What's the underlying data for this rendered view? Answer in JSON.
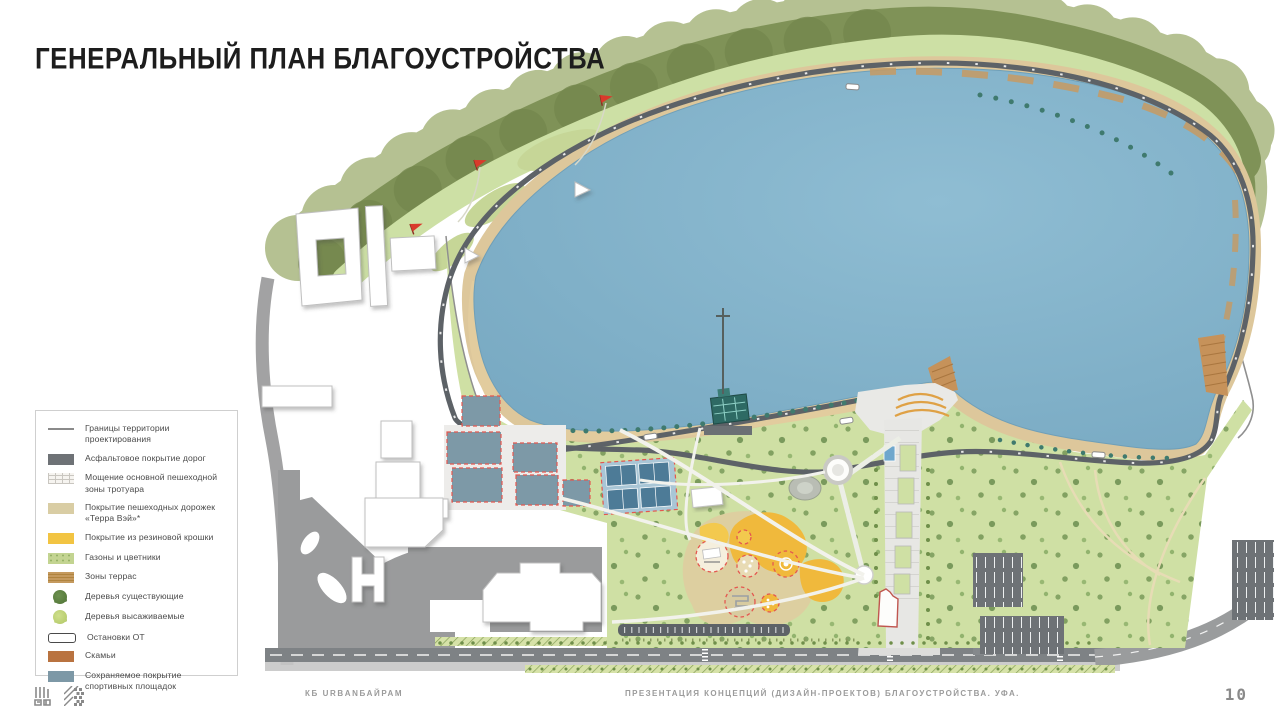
{
  "slide": {
    "title": "ГЕНЕРАЛЬНЫЙ ПЛАН БЛАГОУСТРОЙСТВА",
    "page_number": "10"
  },
  "legend": {
    "items": [
      {
        "id": "boundary",
        "label": "Границы территории проектирования"
      },
      {
        "id": "asphalt",
        "label": "Асфальтовое покрытие дорог"
      },
      {
        "id": "paving",
        "label": "Мощение основной пешеходной зоны тротуара"
      },
      {
        "id": "terraway",
        "label": "Покрытие пешеходных дорожек «Терра Вэй»*"
      },
      {
        "id": "rubber",
        "label": "Покрытие из резиновой крошки"
      },
      {
        "id": "lawn",
        "label": "Газоны и цветники"
      },
      {
        "id": "terrace",
        "label": "Зоны террас"
      },
      {
        "id": "tree_existing",
        "label": "Деревья существующие"
      },
      {
        "id": "tree_planted",
        "label": "Деревья высаживаемые"
      },
      {
        "id": "busstop",
        "label": "Остановки ОТ"
      },
      {
        "id": "bench",
        "label": "Скамьи"
      },
      {
        "id": "court",
        "label": "Сохраняемое покрытие спортивных площадок"
      }
    ]
  },
  "footer": {
    "studio": "КБ URBANБАЙРАМ",
    "presentation": "ПРЕЗЕНТАЦИЯ КОНЦЕПЦИЙ (ДИЗАЙН-ПРОЕКТОВ) БЛАГОУСТРОЙСТВА. УФА.",
    "logos": [
      "dom-rf-logo",
      "ufa-pattern-logo"
    ]
  },
  "map": {
    "subject": "Генеральный план благоустройства набережной озера, Уфа",
    "colors": {
      "lake": "#81b1c8",
      "park_lawn": "#cfe0a4",
      "slope_olive": "#7f9257",
      "tree_canopy": "#b5c192",
      "beach_sand": "#ddc79b",
      "boardwalk": "#c79a61",
      "road_asphalt": "#5d6267",
      "city_road": "#9a9b9c",
      "promenade": "#e7e7e4",
      "playground_rubber": "#f0b93c",
      "terrace_wood": "#c6925a",
      "sport_court": "#7d99a7",
      "accent_red": "#d93a2b"
    }
  }
}
